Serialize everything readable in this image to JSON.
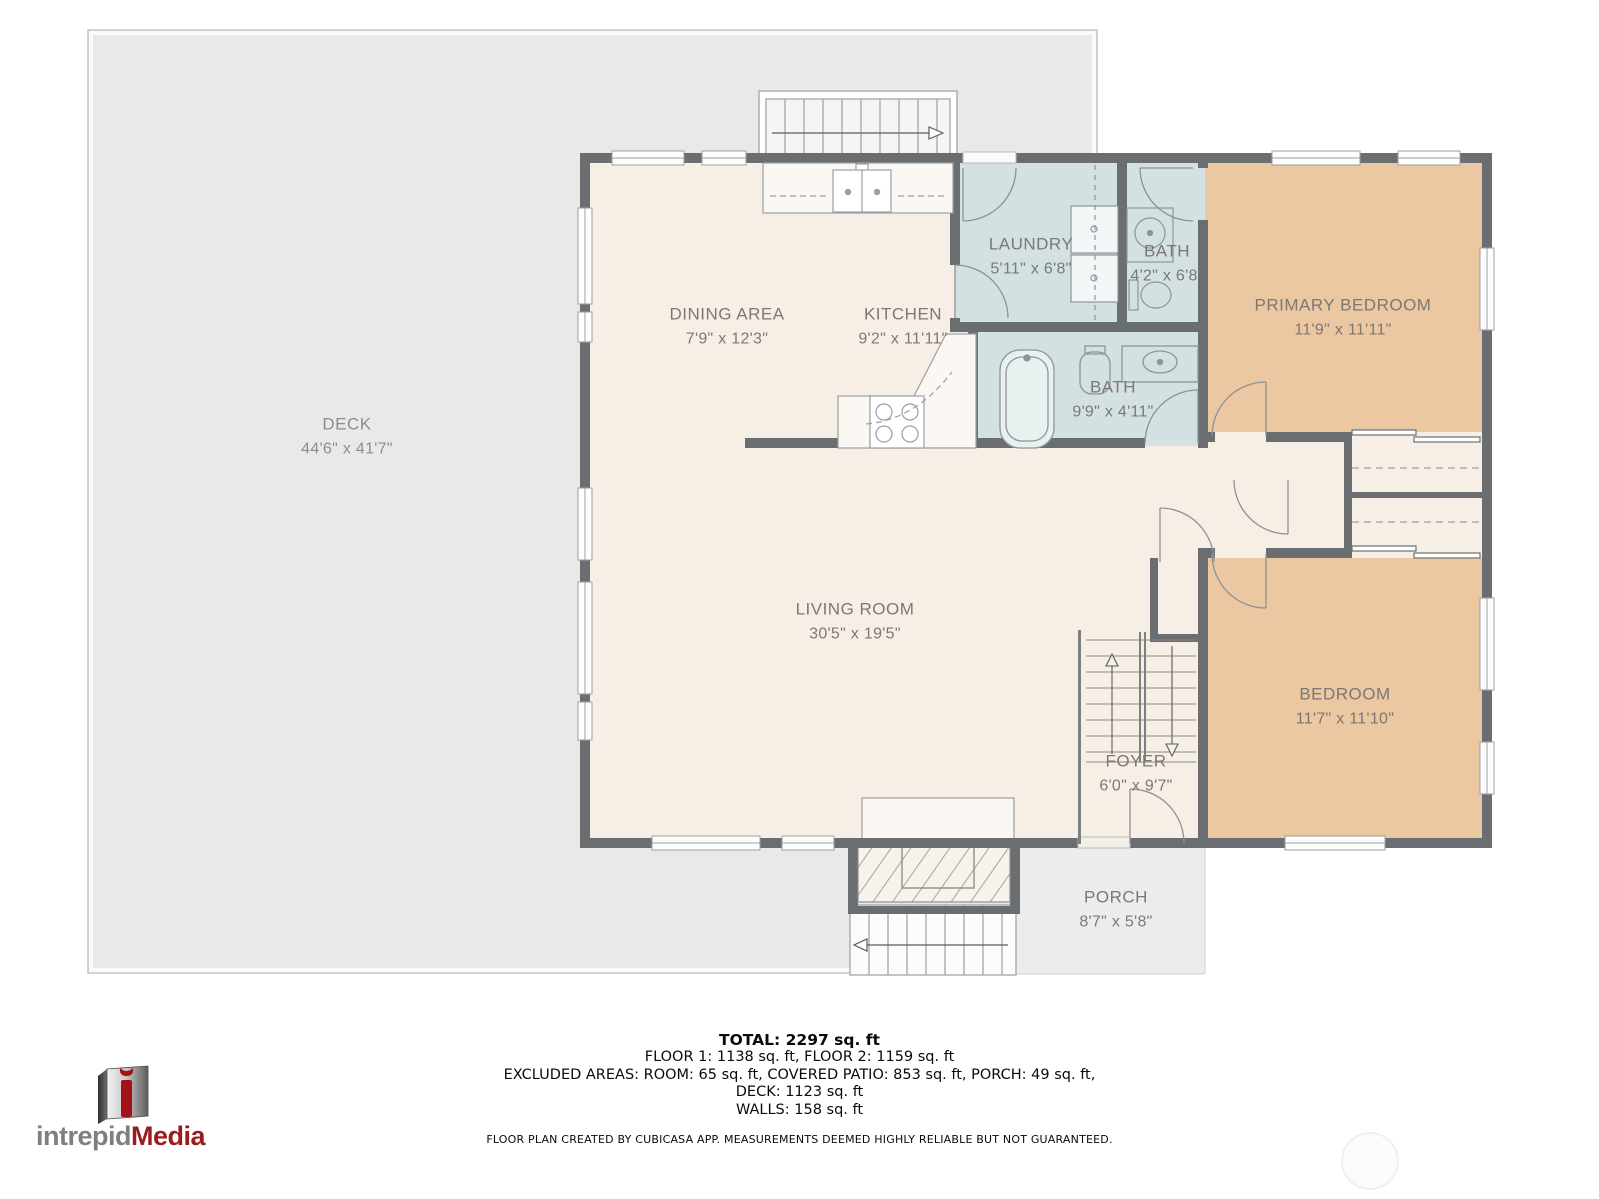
{
  "branding": {
    "logo_text_gray": "intrepid",
    "logo_text_red": "Media"
  },
  "rooms": [
    {
      "name": "DECK",
      "dims": "44'6\" x 41'7\""
    },
    {
      "name": "DINING AREA",
      "dims": "7'9\" x 12'3\""
    },
    {
      "name": "KITCHEN",
      "dims": "9'2\" x 11'11\""
    },
    {
      "name": "LAUNDRY",
      "dims": "5'11\" x 6'8\""
    },
    {
      "name": "BATH",
      "dims": "4'2\" x 6'8\""
    },
    {
      "name": "PRIMARY BEDROOM",
      "dims": "11'9\" x 11'11\""
    },
    {
      "name": "BATH",
      "dims": "9'9\" x 4'11\""
    },
    {
      "name": "LIVING ROOM",
      "dims": "30'5\" x 19'5\""
    },
    {
      "name": "FOYER",
      "dims": "6'0\" x 9'7\""
    },
    {
      "name": "BEDROOM",
      "dims": "11'7\" x 11'10\""
    },
    {
      "name": "PORCH",
      "dims": "8'7\" x 5'8\""
    }
  ],
  "footer": {
    "total": "TOTAL: 2297 sq. ft",
    "floors": "FLOOR 1: 1138 sq. ft, FLOOR 2: 1159 sq. ft",
    "excluded": "EXCLUDED AREAS: ROOM: 65 sq. ft, COVERED PATIO: 853 sq. ft, PORCH: 49 sq. ft,",
    "deck": "DECK: 1123 sq. ft",
    "walls": "WALLS: 158 sq. ft",
    "disclaimer": "FLOOR PLAN CREATED BY CUBICASA APP. MEASUREMENTS DEEMED HIGHLY RELIABLE BUT NOT GUARANTEED."
  },
  "colors": {
    "wall": "#6a6e71",
    "floor": "#f7efe6",
    "wet_room": "#d3e1e2",
    "bedroom": "#ebc7a2",
    "deck": "#e9e9e9",
    "porch": "#ececec",
    "logo_red": "#9c1b1c",
    "label_text": "#7c7872"
  }
}
